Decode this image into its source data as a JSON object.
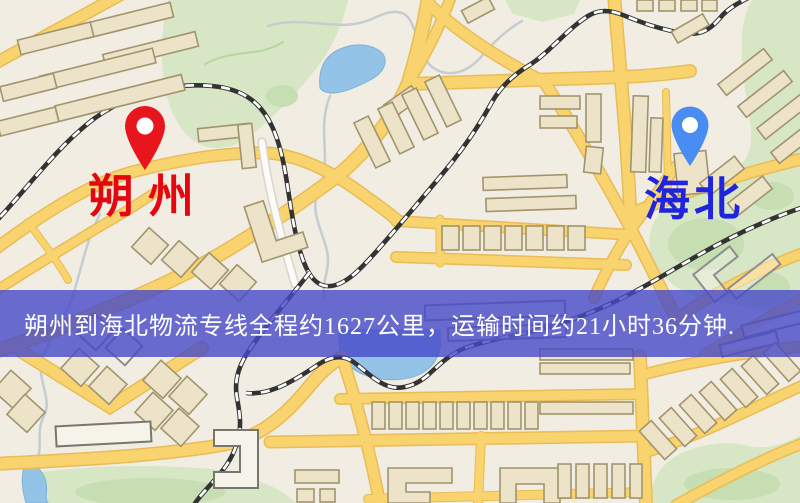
{
  "map": {
    "origin": {
      "label": "朔州",
      "pin_color": "#e8151c",
      "label_color": "#e60610"
    },
    "destination": {
      "label": "海北",
      "pin_color": "#4a8df2",
      "label_color": "#2025dd"
    },
    "route_banner": {
      "text": "朔州到海北物流专线全程约1627公里，运输时间约21小时36分钟.",
      "distance": "约1627公里",
      "duration": "约21小时36分钟",
      "background_color": "#4648c8",
      "text_color": "#ffffff"
    },
    "style_colors": {
      "land": "#f1ede2",
      "park": "#d7e7c5",
      "water": "#93c3e7",
      "road": "#f8d36e",
      "building": "#ece3c8",
      "railway": "#333333"
    }
  }
}
